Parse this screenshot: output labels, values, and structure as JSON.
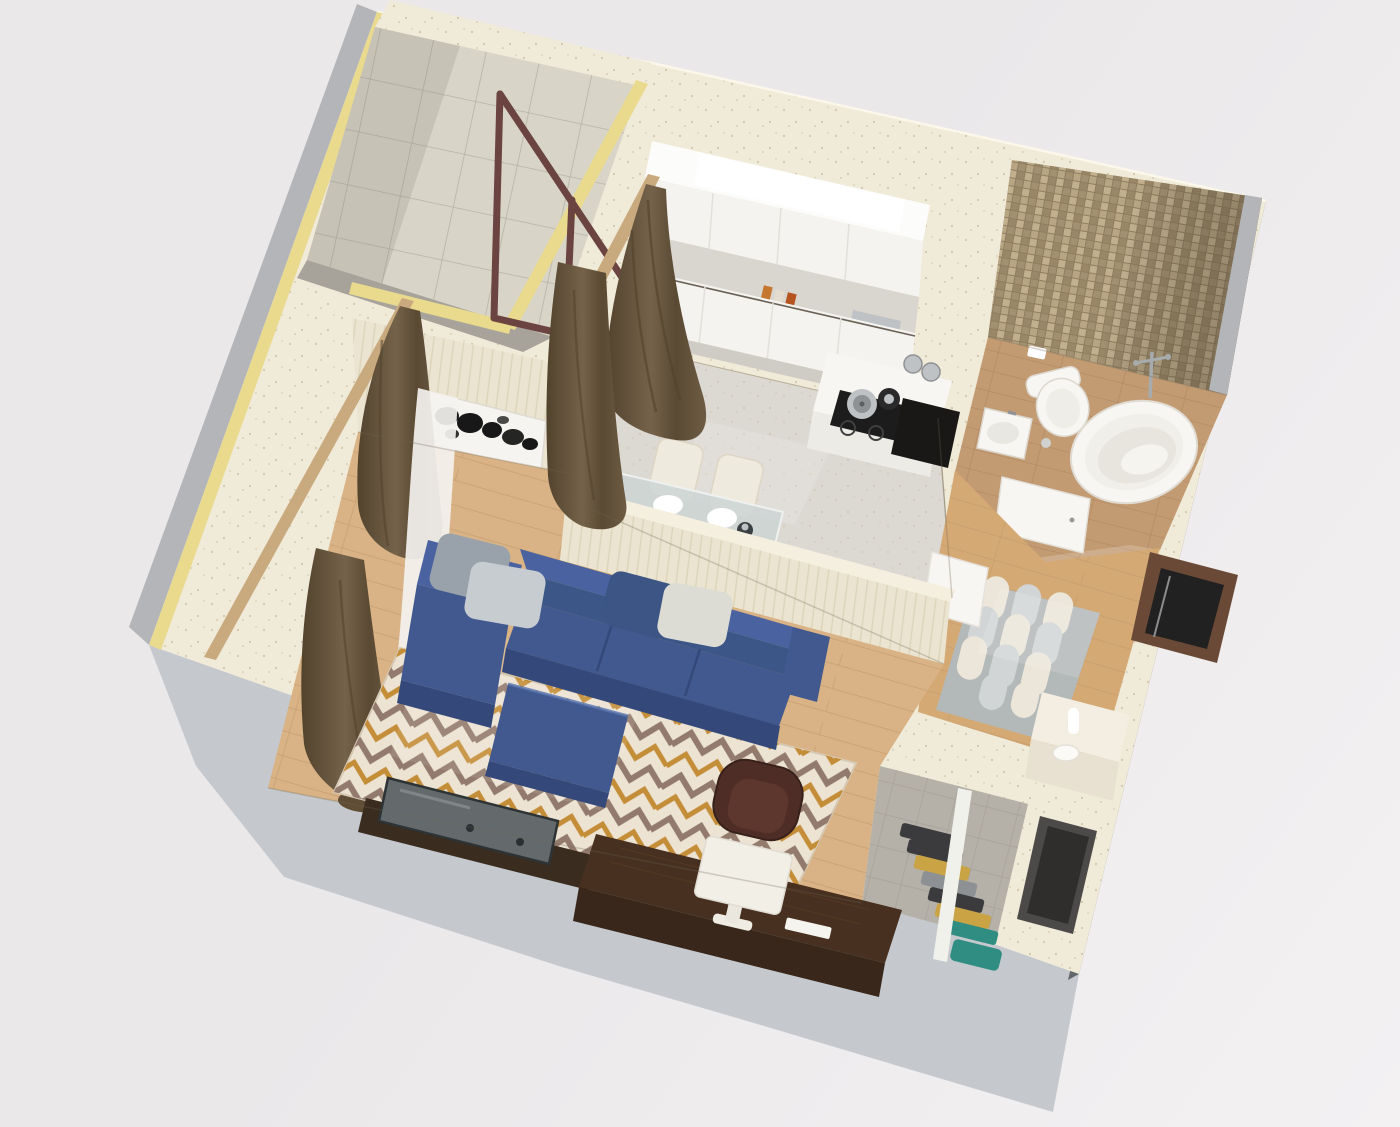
{
  "scene": {
    "title": "3D isometric cutaway floor plan of a one-bedroom apartment",
    "description": "Top-down 3D render showing living room with blue sectional sofa, geometric rug, desk and TV; kitchen with white cabinets and dining table; bathroom with mosaic wall, tub, toilet and basin; hallway with patterned rug and console; wardrobe with hanging clothes; balcony with tiled wall and railing."
  },
  "rooms": [
    {
      "id": "living-room"
    },
    {
      "id": "kitchen"
    },
    {
      "id": "bathroom"
    },
    {
      "id": "hallway"
    },
    {
      "id": "wardrobe"
    },
    {
      "id": "balcony"
    }
  ],
  "palette": {
    "bg1": "#eae8e9",
    "bg2": "#f3f1f2",
    "wallTop": "#f0ead8",
    "wallSpeckle": "#cfc4a6",
    "faceLight": "#c5c9ce",
    "faceSliver": "#b4b5b8",
    "faceDark": "#63666a",
    "yellow": "#e9da8e",
    "tileBase": "#d8d4c7",
    "tileLine": "#b6b2a5",
    "balconyShade": "#a8a39a",
    "railing": "#6b4340",
    "kitchenFloor": "#dcd8d2",
    "kitchenFleck": "#b9b1a6",
    "cabinetFront": "#f4f3ef",
    "cabinetTop": "#fcfcfb",
    "counterGray": "#d9d5cf",
    "plinth": "#cfccc5",
    "cooktop": "#1c1c1c",
    "steel": "#bfc2c4",
    "steelDark": "#8f9294",
    "nicheBlack": "#191817",
    "glassTable": "#ccd5d4",
    "chairCream": "#efeade",
    "mosaicBase": "#8f7d60",
    "mosaicA": "#b7a584",
    "mosaicB": "#a29070",
    "mosaicC": "#c1af8e",
    "mosaicD": "#998767",
    "bathFloor": "#c39b72",
    "bathFloorLine": "#a9845e",
    "white": "#f8f6f2",
    "whiteShade": "#ecebe6",
    "hallWood": "#d5a974",
    "woodLine": "#c09a6b",
    "livingWood": "#d9b385",
    "rugBase": "#ece3d3",
    "rugTaupe": "#8d7467",
    "rugGold": "#c2882f",
    "hallRugBase": "#b3b8b9",
    "hallRugCream": "#ece6da",
    "hallRugGray": "#d2d5d6",
    "consoleCream": "#f3eee1",
    "consoleFront": "#e8e1d1",
    "entryWood": "#6a4a36",
    "doorDark": "#212121",
    "vestibule": "#4b4a48",
    "vestibuleInner": "#2f2e2c",
    "wardFloor": "#b5b0a8",
    "railWhite": "#f1f1ec",
    "clothDark": "#3b3b3e",
    "clothGray": "#8e9194",
    "clothYellow": "#caa344",
    "clothTeal": "#2f8d81",
    "panelCream": "#ebe4d0",
    "panelLine": "#dcd3b9",
    "pelmet": "#c9a97e",
    "curtain": "#6e5c44",
    "curtainDark": "#52432d",
    "sheer": "#f4f2ef",
    "sofa": "#41598e",
    "sofaDark": "#34497a",
    "sofaMid": "#3c5787",
    "sofaLight": "#4a63a0",
    "pillowGray": "#99a2ab",
    "pillowLight": "#c7ccd1",
    "pillowNavy": "#3d5584",
    "pillowCream": "#dcdcd4",
    "deskWood": "#47301f",
    "deskDark": "#38271a",
    "chairBrown": "#4e2d26",
    "chairSeat": "#5d362d",
    "tv": "#646a6c",
    "tvFrame": "#2e3335",
    "tvStand": "#3a2c1f",
    "artRed": "#b23b2e",
    "artOrange": "#d9772e",
    "artYellow": "#e3b33c",
    "artTeal": "#3f8fa6",
    "artBlue": "#2b6f8e",
    "artMaroon": "#7a1f1f"
  }
}
